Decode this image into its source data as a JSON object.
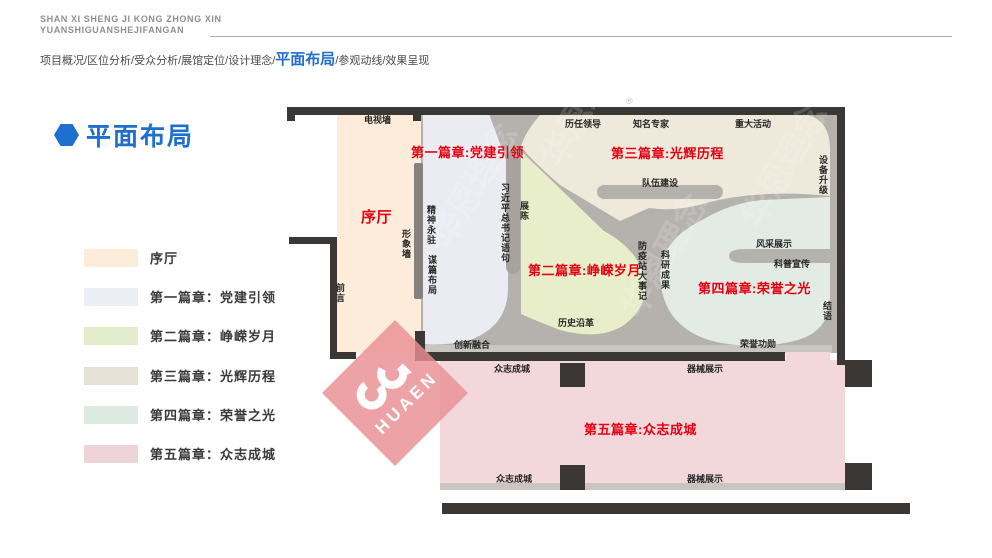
{
  "header": {
    "line1": "SHAN XI SHENG JI KONG ZHONG XIN",
    "line2": "YUANSHIGUANSHEJIFANGAN"
  },
  "nav": {
    "before": "项目概况/区位分析/受众分析/展馆定位/设计理念/",
    "active": "平面布局",
    "after": "/参观动线/效果呈现"
  },
  "section_title": "平面布局",
  "legend": {
    "items": [
      {
        "label": "序厅",
        "color": "#fcecd9"
      },
      {
        "label": "第一篇章：党建引领",
        "color": "#eceef6"
      },
      {
        "label": "第二篇章：峥嵘岁月",
        "color": "#e3edcb"
      },
      {
        "label": "第三篇章：光辉历程",
        "color": "#e5e1d7"
      },
      {
        "label": "第四篇章：荣誉之光",
        "color": "#dceae2"
      },
      {
        "label": "第五篇章：众志成城",
        "color": "#eed4da"
      }
    ]
  },
  "plan": {
    "labels": {
      "tv_wall": "电视墙",
      "ch1": "第一篇章:党建引领",
      "xuting": "序厅",
      "image_wall": "形象墙",
      "qianyan": "前言",
      "spirit": "精神永驻",
      "planning": "谋篇布局",
      "xi_quote": "习近平总书记语句",
      "zhanchen": "展陈",
      "innovation": "创新融合",
      "ch2": "第二篇章:峥嵘岁月",
      "history": "历史沿革",
      "epidemic": "防疫站大事记",
      "research": "科研成果",
      "leaders": "历任领导",
      "experts": "知名专家",
      "events": "重大活动",
      "ch3": "第三篇章:光辉历程",
      "team": "队伍建设",
      "equipment": "设备升级",
      "fengcai": "风采展示",
      "kepu": "科普宣传",
      "ch4": "第四篇章:荣誉之光",
      "jieyu": "结语",
      "honor": "荣誉功勋",
      "unity_top": "众志成城",
      "device_top": "器械展示",
      "ch5": "第五篇章:众志成城",
      "unity_bottom": "众志成城",
      "device_bottom": "器械展示"
    },
    "colors": {
      "wall": "#3b3734",
      "corridor": "#b5b1ad",
      "strip": "#c9c5c1",
      "xuting": "#fcecd9",
      "ch1": "#ebecf2",
      "ch2": "#e7eec9",
      "ch3": "#efe9db",
      "ch4": "#e2ebe4",
      "ch5": "#f2d7db"
    }
  },
  "watermark": {
    "brand": "HUAEN",
    "ghost": "华恩理念",
    "reg": "®",
    "color": "#e98f93"
  },
  "accent_color": "#1e6fd0",
  "chapter_red": "#e60012"
}
